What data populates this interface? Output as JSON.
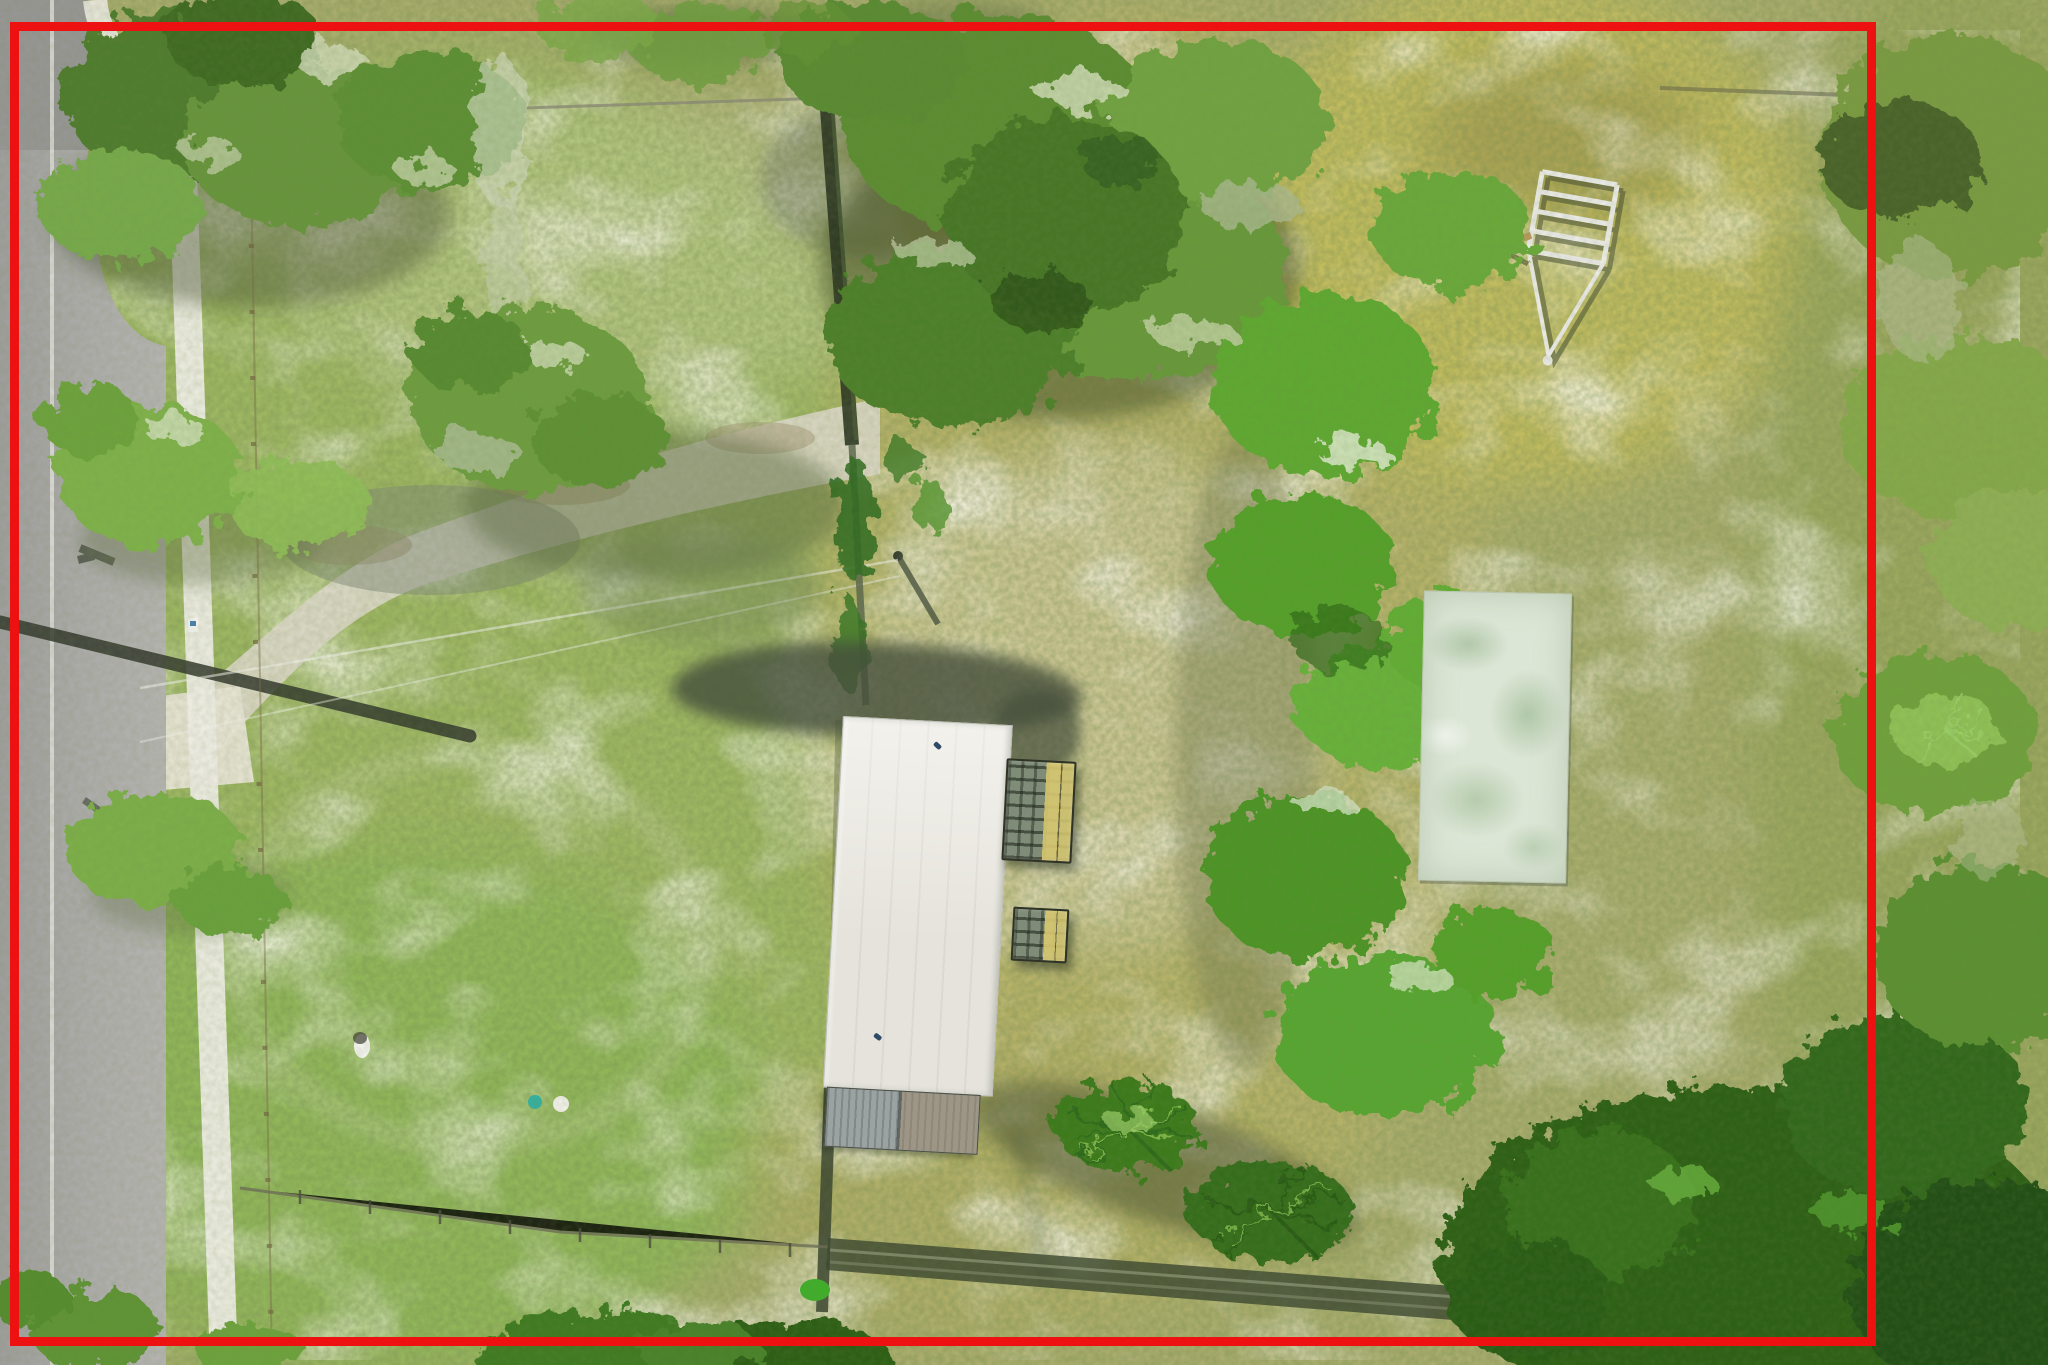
{
  "image": {
    "kind": "aerial-drone-photo",
    "description": "Top-down aerial photograph of a rectangular grassy residential lot outlined with a red property-boundary overlay. A gray street and white sidewalk run along the left edge; a sandy dirt driveway crosses the upper lawn; a white-roofed house with metal shed panels and two lattice deck stairs sits at center; a mossy concrete pad lies by the right tree line; large oak canopies cover the top; a boat trailer is parked in the upper-right clearing; dense shrubs fill the lower right; fences cross the lot at top, middle and bottom."
  },
  "overlay": {
    "name": "property-boundary",
    "shape": "rectangle",
    "color": "#ee1111",
    "stroke_px": 9
  },
  "palette": {
    "ground_base": "#a9ad6e",
    "lawn": "#9cb863",
    "field": "#b6b269",
    "moss_field": "#c1bc60",
    "sand": "#e7e4d2",
    "road": "#a7a7a5",
    "sidewalk": "#ecebe3",
    "roof": "#eceae2",
    "pad": "#dce6d6",
    "fence_yellow": "#e4e43c",
    "canopy_dark": "#33571c",
    "canopy_bright": "#5ea832",
    "shadow": "#3c4a2e"
  },
  "features": [
    {
      "name": "road",
      "label": "street along left edge"
    },
    {
      "name": "road-edge-line",
      "label": "white painted road edge line"
    },
    {
      "name": "sidewalk",
      "label": "concrete sidewalk strip"
    },
    {
      "name": "driveway",
      "label": "worn sandy driveway"
    },
    {
      "name": "house-roof",
      "label": "white gabled metal roof"
    },
    {
      "name": "metal-shed",
      "label": "corrugated shed panels"
    },
    {
      "name": "deck-stairs",
      "label": "two lattice porch decks"
    },
    {
      "name": "concrete-pad",
      "label": "moss-stained concrete slab"
    },
    {
      "name": "front-fence",
      "label": "panel fence along top"
    },
    {
      "name": "yellow-fence-panel",
      "label": "yellow fence section"
    },
    {
      "name": "cross-fence",
      "label": "dark fence line through lot center"
    },
    {
      "name": "side-fence",
      "label": "post fence beside sidewalk"
    },
    {
      "name": "rear-fence",
      "label": "rear fence with long shadow"
    },
    {
      "name": "oak-canopies",
      "label": "oak tree canopies"
    },
    {
      "name": "tree-line-right",
      "label": "tree line on right"
    },
    {
      "name": "shrubs-bottom-right",
      "label": "dense dark shrubs"
    },
    {
      "name": "boat-trailer",
      "label": "boat trailer frame"
    },
    {
      "name": "utility-pole",
      "label": "utility pole and shadow"
    },
    {
      "name": "power-lines",
      "label": "overhead power lines"
    },
    {
      "name": "palm-fronds",
      "label": "palmetto fronds by shed"
    },
    {
      "name": "property-boundary",
      "label": "red parcel outline"
    }
  ]
}
